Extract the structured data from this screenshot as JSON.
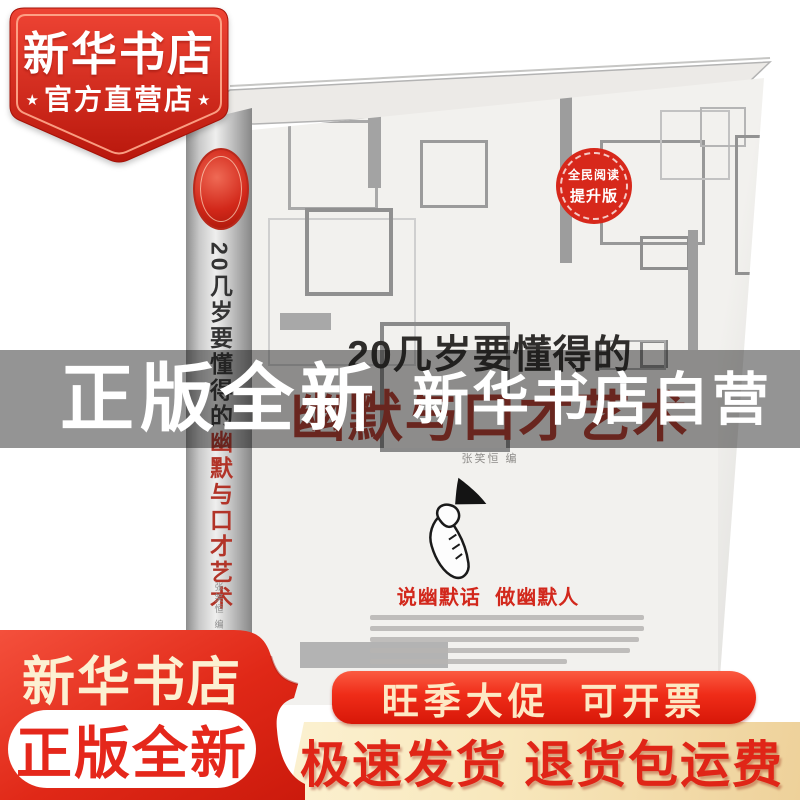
{
  "store_badge": {
    "name": "新华书店",
    "sub": "官方直营店",
    "star": "★"
  },
  "book": {
    "subtitle": "20几岁要懂得的",
    "title": "幽默与口才艺术",
    "author": "张笑恒 编",
    "slogan": "说幽默话 做幽默人",
    "cover_badge_line1": "全民阅读",
    "cover_badge_line2": "提升版"
  },
  "mid_banner": {
    "left": "正版全新",
    "right": "新华书店自营"
  },
  "bottom_left": {
    "store": "新华书店",
    "pill": "正版全新"
  },
  "promo_pill": {
    "text": "旺季大促  可开票"
  },
  "shipping_banner": {
    "text": "极速发货 退货包运费"
  },
  "colors": {
    "brand_red": "#d7281b",
    "deep_red": "#b8170c",
    "cream_text": "#fcf0d2",
    "cream_banner": "#f8e8bd",
    "cover_title_red": "#b1382b",
    "overlay": "rgba(18,18,18,0.45)"
  }
}
